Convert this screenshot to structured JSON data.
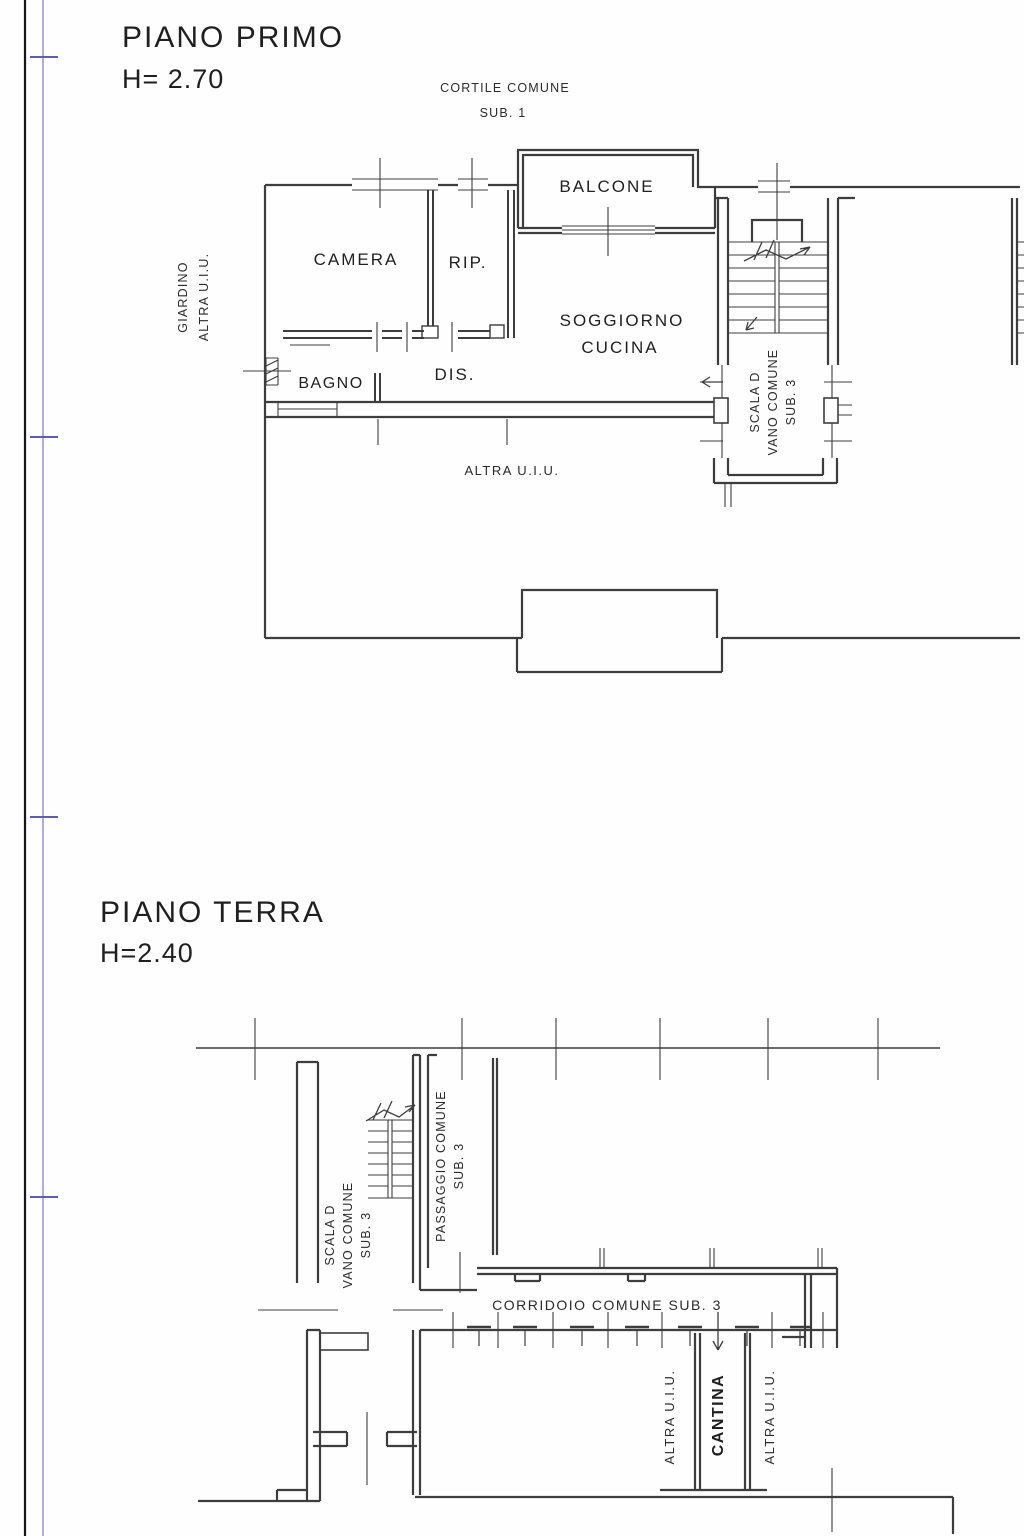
{
  "sheet": {
    "type": "cadastral floor plan",
    "paper_color": "#fefefe",
    "wall_color": "#3d3d3d",
    "detail_color": "#4a4a4a",
    "text_color": "#1f1f1f",
    "margin_black_line_color": "#161616",
    "margin_blue_line_color": "#5d5db8"
  },
  "floor1": {
    "title": "PIANO PRIMO",
    "height_label": "H= 2.70",
    "outside": {
      "cortile": "CORTILE COMUNE",
      "cortile_sub": "SUB. 1",
      "giardino_line1": "GIARDINO",
      "giardino_line2": "ALTRA U.I.U.",
      "altra_uiu": "ALTRA U.I.U."
    },
    "rooms": {
      "balcone": "BALCONE",
      "camera": "CAMERA",
      "rip": "RIP.",
      "soggiorno_line1": "SOGGIORNO",
      "soggiorno_line2": "CUCINA",
      "bagno": "BAGNO",
      "dis": "DIS.",
      "scala_line1": "SCALA D",
      "scala_line2": "VANO COMUNE",
      "scala_line3": "SUB. 3"
    }
  },
  "floor0": {
    "title": "PIANO TERRA",
    "height_label": "H=2.40",
    "rooms": {
      "scala_line1": "SCALA D",
      "scala_line2": "VANO COMUNE",
      "scala_line3": "SUB. 3",
      "passaggio_line1": "PASSAGGIO COMUNE",
      "passaggio_line2": "SUB. 3",
      "corridoio": "CORRIDOIO COMUNE SUB. 3",
      "altra_uiu_left": "ALTRA U.I.U.",
      "cantina": "CANTINA",
      "altra_uiu_right": "ALTRA U.I.U."
    }
  }
}
